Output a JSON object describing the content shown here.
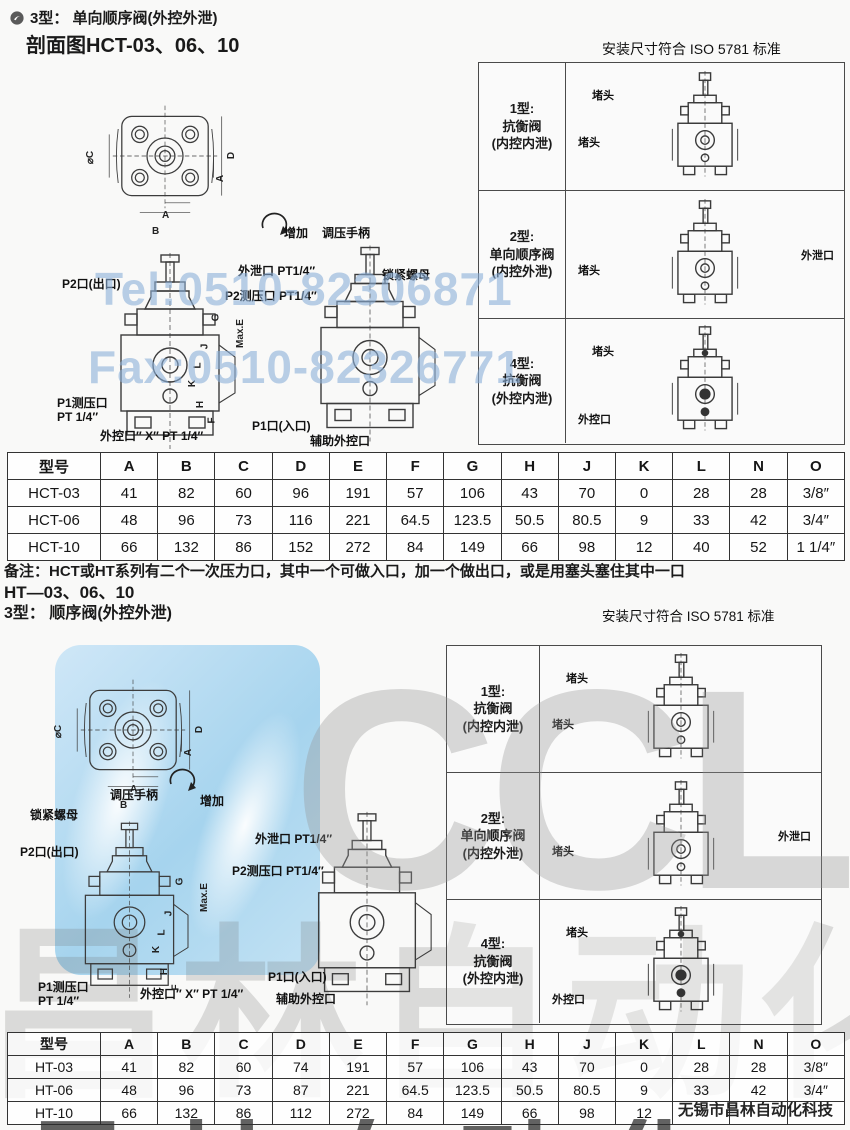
{
  "header": {
    "section_title": "3型： 单向顺序阀(外控外泄)",
    "subtitle": "剖面图HCT-03、06、10",
    "iso_note": "安装尺寸符合 ISO 5781 标准"
  },
  "section2": {
    "series_title": "HT—03、06、10",
    "section_title": "3型： 顺序阀(外控外泄)",
    "iso_note": "安装尺寸符合 ISO 5781 标准"
  },
  "note": "备注：HCT或HT系列有二个一次压力口，其中一个可做入口，加一个做出口，或是用塞头塞住其中一口",
  "watermark": {
    "tel": "Tel:0510-82306871",
    "fax": "Fax:0510-82326771",
    "brand": "CCLair",
    "company": "无锡市昌林自动化科技",
    "cn_big": "昌林自动化",
    "blue_color": "#8aafd8",
    "gray_color": "#969696"
  },
  "diagram": {
    "increase": "增加",
    "handle": "调压手柄",
    "lock_nut": "锁紧螺母",
    "p2_port": "P2口(出口)",
    "p1_gauge_line1": "P1测压口",
    "p1_gauge_line2": "PT 1/4″",
    "ext_ctrl": "外控口″ X″ PT 1/4″",
    "drain": "外泄口 PT1/4″",
    "p2_gauge": "P2测压口 PT1/4″",
    "p1_port": "P1口(入口)",
    "aux_ctrl": "辅助外控口",
    "flange_dims": [
      "⌀C",
      "A",
      "B",
      "A",
      "D"
    ],
    "section_dims": [
      "G",
      "J",
      "L",
      "K",
      "H",
      "F",
      "Max.E"
    ]
  },
  "type_panel": {
    "rows": [
      {
        "label": "1型:\n抗衡阀\n(内控内泄)",
        "top_label": "堵头",
        "bottom_label": "堵头",
        "right_label": ""
      },
      {
        "label": "2型:\n单向顺序阀\n(内控外泄)",
        "top_label": "",
        "bottom_label": "堵头",
        "right_label": "外泄口"
      },
      {
        "label": "4型:\n抗衡阀\n(外控内泄)",
        "top_label": "堵头",
        "bottom_label": "外控口",
        "right_label": ""
      }
    ]
  },
  "table1": {
    "headers": [
      "型号",
      "A",
      "B",
      "C",
      "D",
      "E",
      "F",
      "G",
      "H",
      "J",
      "K",
      "L",
      "N",
      "O"
    ],
    "rows": [
      [
        "HCT-03",
        "41",
        "82",
        "60",
        "96",
        "191",
        "57",
        "106",
        "43",
        "70",
        "0",
        "28",
        "28",
        "3/8″"
      ],
      [
        "HCT-06",
        "48",
        "96",
        "73",
        "116",
        "221",
        "64.5",
        "123.5",
        "50.5",
        "80.5",
        "9",
        "33",
        "42",
        "3/4″"
      ],
      [
        "HCT-10",
        "66",
        "132",
        "86",
        "152",
        "272",
        "84",
        "149",
        "66",
        "98",
        "12",
        "40",
        "52",
        "1 1/4″"
      ]
    ]
  },
  "table2": {
    "headers": [
      "型号",
      "A",
      "B",
      "C",
      "D",
      "E",
      "F",
      "G",
      "H",
      "J",
      "K",
      "L",
      "N",
      "O"
    ],
    "rows": [
      [
        "HT-03",
        "41",
        "82",
        "60",
        "74",
        "191",
        "57",
        "106",
        "43",
        "70",
        "0",
        "28",
        "28",
        "3/8″"
      ],
      [
        "HT-06",
        "48",
        "96",
        "73",
        "87",
        "221",
        "64.5",
        "123.5",
        "50.5",
        "80.5",
        "9",
        "33",
        "42",
        "3/4″"
      ],
      [
        "HT-10",
        "66",
        "132",
        "86",
        "112",
        "272",
        "84",
        "149",
        "66",
        "98",
        "12",
        "",
        "",
        ""
      ]
    ]
  }
}
